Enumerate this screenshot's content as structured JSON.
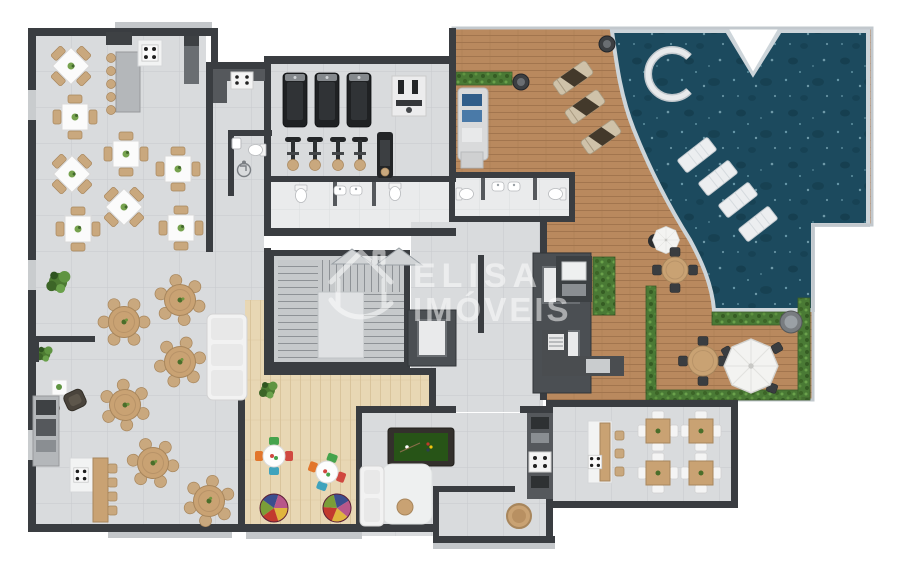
{
  "watermark": {
    "line1": "ELISA",
    "line2": "IMÓVEIS",
    "logo_icon": "house-swoosh-icon"
  },
  "icons": {
    "accessibility": "wheelchair-icon",
    "cooktop": "four-burner-stove-icon"
  },
  "palette": {
    "background": "#ffffff",
    "wall": "#3a3d41",
    "wall_light": "#55585c",
    "tile_floor": "#d9dbdd",
    "tile_line": "#c8cacd",
    "tile_light": "#eaebec",
    "tile_light_line": "#dbdcde",
    "deck_wood": "#b9895e",
    "deck_line": "#a2754e",
    "light_wood": "#e8d7b4",
    "light_wood_line": "#d9c49c",
    "pool_water": "#1c4a5e",
    "pool_edge": "#cdd5da",
    "hedge": "#4a7a35",
    "table_wood": "#c9a273",
    "chair_tan": "#c9a87e",
    "marble": "#b4b7ba",
    "dark_marble": "#4b4f53",
    "felt_green": "#275417",
    "accent_blue": "#2f5d8a",
    "watermark_color": "#ffffff"
  }
}
